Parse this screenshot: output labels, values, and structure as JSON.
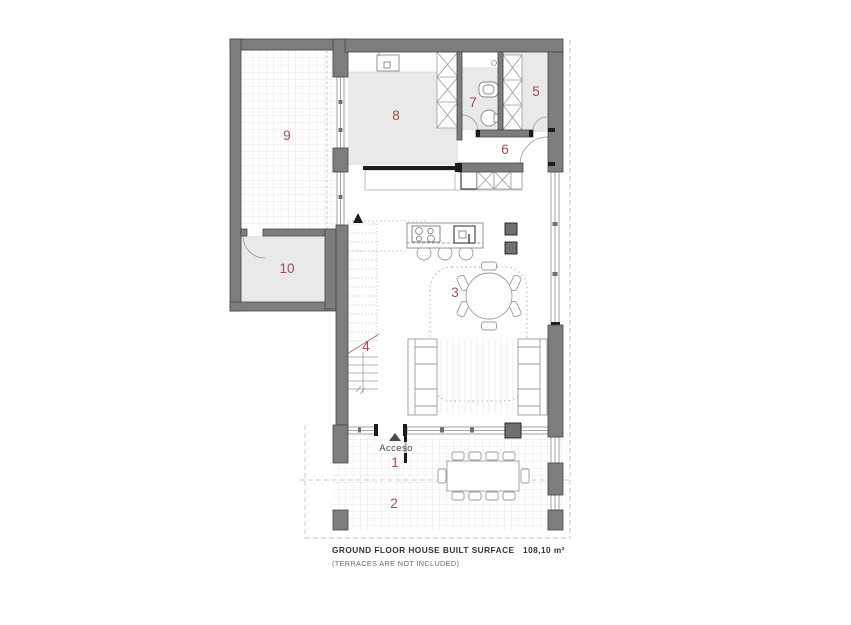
{
  "plan": {
    "room_numbers": [
      "1",
      "2",
      "3",
      "4",
      "5",
      "6",
      "7",
      "8",
      "9",
      "10"
    ],
    "access_label": "Acceso"
  },
  "footer": {
    "title": "GROUND FLOOR HOUSE BUILT SURFACE",
    "note": "(TERRACES ARE NOT INCLUDED)",
    "area": "108,10 m²"
  },
  "colors": {
    "wall": "#7d7d7d",
    "wall_outline": "#474747",
    "room_fill": "#e9e9e9",
    "room_number": "#a34e48",
    "grid_line": "#dcdcdc",
    "furniture_line": "#999999",
    "black_detail": "#1c1c1c",
    "dashed_line": "#c4c4c4",
    "text_dark": "#333333",
    "text_muted": "#6b6b6b"
  }
}
